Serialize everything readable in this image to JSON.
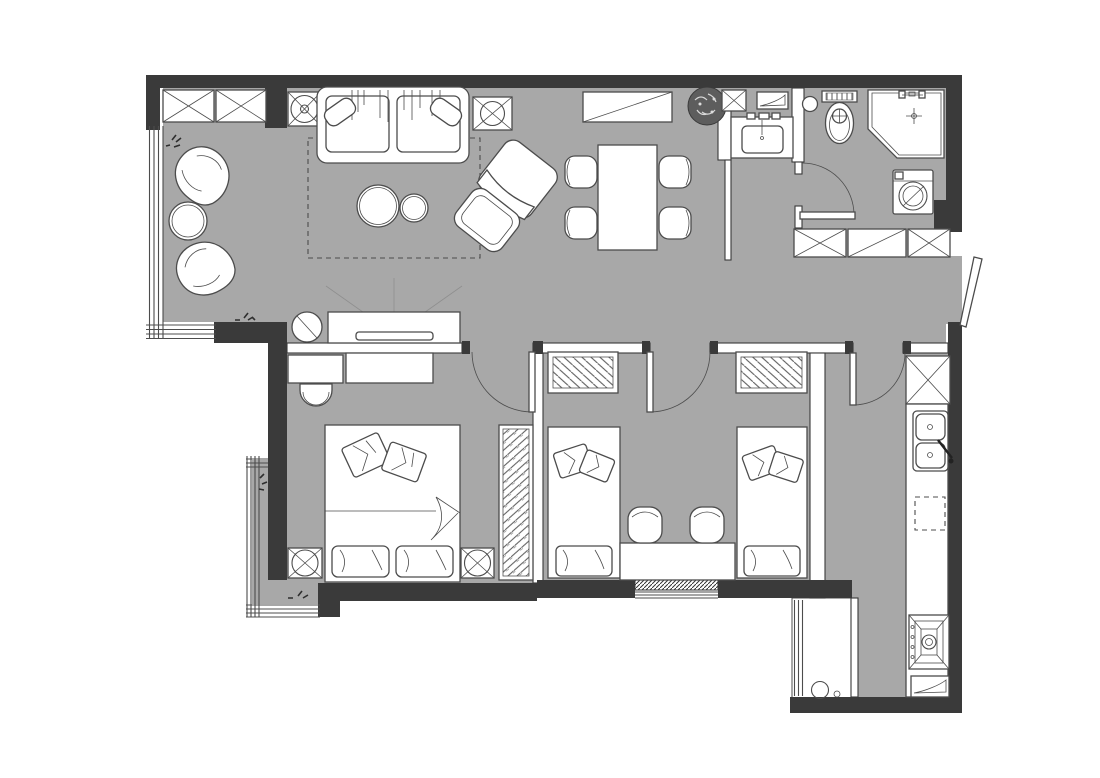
{
  "meta": {
    "type": "architectural-floor-plan",
    "view": "top-down 2D apartment plan, grayscale, no text labels",
    "visible_text": []
  },
  "palette": {
    "background": "#ffffff",
    "floor": "#a8a8a8",
    "wall": "#3a3a3a",
    "line": "#4c4c4c",
    "furniture": "#ffffff",
    "accent_dark": "#5d5d5d"
  },
  "rooms": [
    {
      "id": "living-dining",
      "label": "living and dining area",
      "floor": "gray",
      "items": [
        "built-in-wardrobe x2",
        "lamp-side-table",
        "three-seat-sofa",
        "sofa-cushion x2",
        "side-table",
        "sideboard",
        "potted-plant",
        "rug-dashed-outline",
        "coffee-table-large",
        "coffee-table-small",
        "lounge-chair",
        "ottoman",
        "dining-table",
        "dining-chair x4",
        "shell-armchair x2",
        "round-side-table",
        "tv-console",
        "tv",
        "accent-round-table"
      ]
    },
    {
      "id": "master-bedroom",
      "label": "master bedroom",
      "floor": "gray",
      "items": [
        "dresser-unit x2",
        "desk-chair",
        "double-bed",
        "bed-pillow x2",
        "throw-pillow x2",
        "nightstand-with-lamp x2",
        "radiator-panel"
      ]
    },
    {
      "id": "second-bedroom",
      "label": "second bedroom",
      "floor": "gray",
      "items": [
        "single-bed x2",
        "headboard-radiator x2",
        "bed-pillow x2",
        "throw-pillow x4",
        "shared-desk",
        "desk-chair x2"
      ]
    },
    {
      "id": "bathroom",
      "label": "bathroom",
      "floor": "gray",
      "items": [
        "duct-shaft",
        "vent-hatch",
        "vanity-sink",
        "waste-bin",
        "toilet",
        "corner-shower",
        "washing-machine"
      ]
    },
    {
      "id": "hallway",
      "label": "entry hallway",
      "floor": "gray",
      "items": [
        "wardrobe-section x3",
        "entry-door"
      ]
    },
    {
      "id": "kitchen",
      "label": "galley kitchen",
      "floor": "gray",
      "items": [
        "tall-cabinet-fridge",
        "counter-run",
        "double-bowl-sink",
        "undercounter-appliance-dashed",
        "cooktop",
        "vent-hatch"
      ]
    },
    {
      "id": "master-balcony",
      "label": "bedroom balcony",
      "floor": "gray",
      "items": [
        "plant-sprig x2"
      ]
    },
    {
      "id": "service-balcony",
      "label": "service balcony",
      "floor": "white",
      "items": [
        "water-heater",
        "floor-drain"
      ]
    }
  ],
  "openings": {
    "doors": [
      "entry-door",
      "bathroom-door",
      "master-bedroom-door",
      "second-bedroom-door",
      "kitchen-door"
    ],
    "windows": [
      "living-bay-window",
      "master-balcony-window",
      "second-bedroom-window",
      "service-balcony-window"
    ]
  }
}
